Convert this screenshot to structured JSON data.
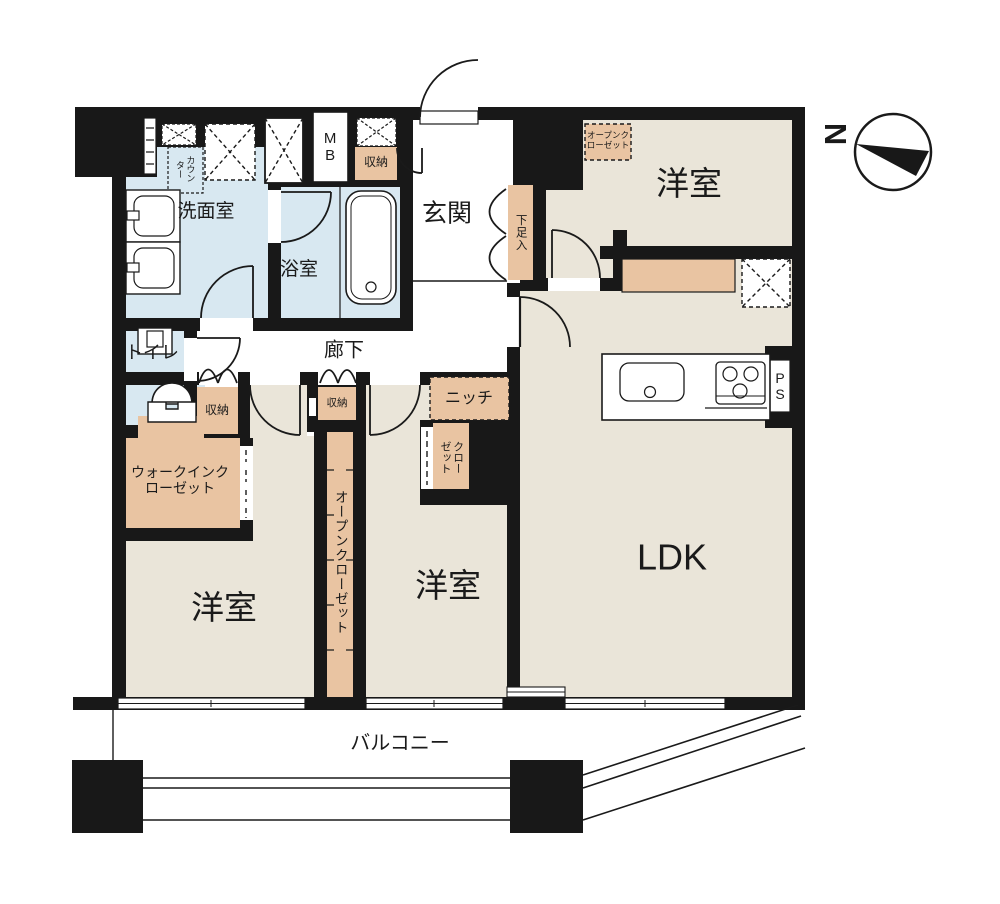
{
  "plan": {
    "type": "apartment-floor-plan",
    "labels": {
      "ldk": "LDK",
      "bedroom1": "洋室",
      "bedroom2": "洋室",
      "bedroom3": "洋室",
      "entrance": "玄関",
      "washroom": "洗面室",
      "bathroom": "浴室",
      "toilet": "トイレ",
      "corridor": "廊下",
      "balcony": "バルコニー",
      "niche": "ニッチ",
      "shoe_cabinet": "下足入",
      "storage_top": "収納",
      "storage_hall_1": "収納",
      "storage_hall_2": "収納",
      "closet": "クローゼット",
      "open_closet_strip": "オープンクローゼット",
      "open_closet_small": "オープンクローゼット",
      "walk_in_closet": "ウォークインクローゼット",
      "counter": "カウンター",
      "meter_box": "MB",
      "pipe_space": "PS",
      "north": "N"
    },
    "colors": {
      "wall": "#181818",
      "room_floor": "#eae5d9",
      "wet_area": "#d8e8f1",
      "storage": "#e9c4a2",
      "line": "#1a1a1a",
      "background": "#ffffff"
    }
  }
}
